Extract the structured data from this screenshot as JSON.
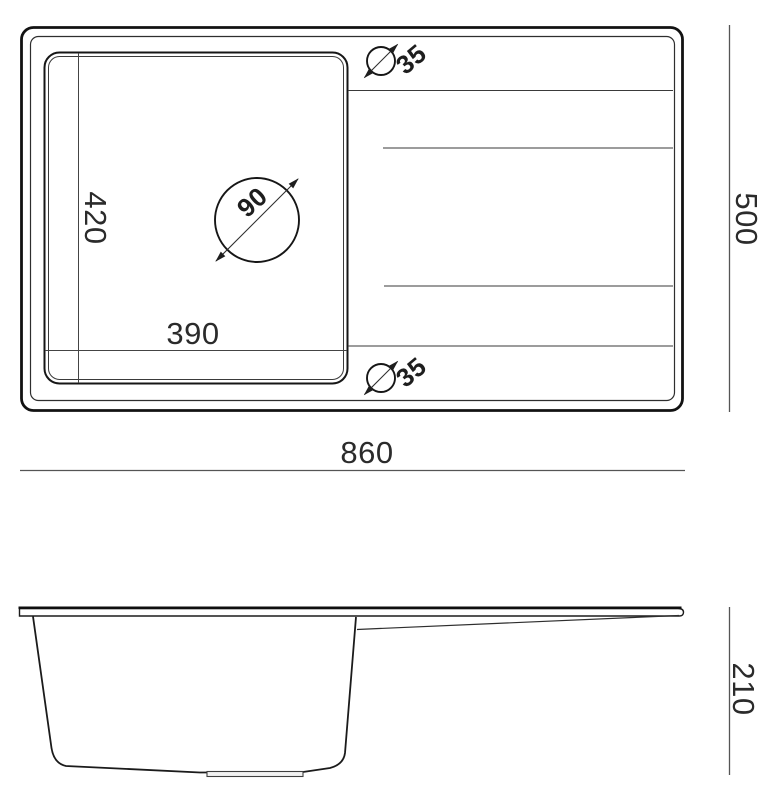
{
  "drawing": {
    "top_view": {
      "overall_width_mm": "860",
      "overall_depth_mm": "500",
      "bowl_width_mm": "390",
      "bowl_depth_mm": "420",
      "drain_hole_diameter_mm": "90",
      "tap_hole_top_diameter_mm": "35",
      "tap_hole_bottom_diameter_mm": "35"
    },
    "side_view": {
      "overall_height_mm": "210"
    }
  },
  "colors": {
    "background": "#ffffff",
    "heavy_line": "#121212",
    "line": "#2e2e2e",
    "thin_line": "#3a3a3a",
    "dim_line": "#555555",
    "text": "#2b2b2b"
  }
}
